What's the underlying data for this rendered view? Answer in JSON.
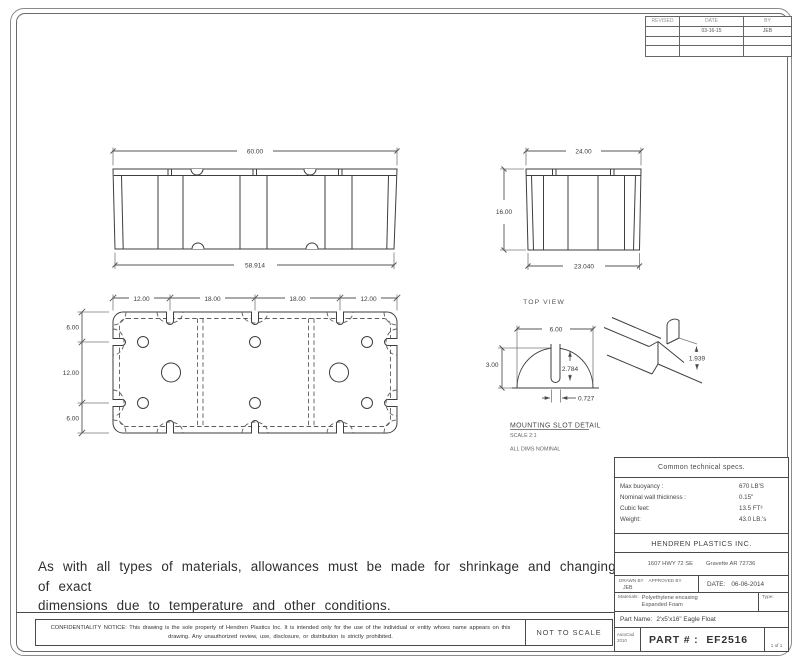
{
  "revision_table": {
    "headers": [
      "REVISED",
      "DATE",
      "BY"
    ],
    "rows": [
      {
        "revised": "",
        "date": "03-16-15",
        "by": "JEB"
      },
      {
        "revised": "",
        "date": "",
        "by": ""
      },
      {
        "revised": "",
        "date": "",
        "by": ""
      }
    ]
  },
  "views": {
    "front": {
      "dim_width_top": "60.00",
      "dim_width_bottom": "58.914"
    },
    "side": {
      "dim_width_top": "24.00",
      "dim_width_bottom": "23.040",
      "dim_height": "16.00"
    },
    "top": {
      "label": "TOP VIEW",
      "dims_top": [
        "12.00",
        "18.00",
        "18.00",
        "12.00"
      ],
      "dims_left": [
        "6.00",
        "12.00",
        "6.00"
      ]
    },
    "slot_detail": {
      "title": "MOUNTING SLOT DETAIL",
      "scale": "SCALE 2:1",
      "note": "ALL DIMS NOMINAL",
      "dim_width": "6.00",
      "dim_height": "3.00",
      "dim_depth": "2.784",
      "dim_slot_width": "0.727"
    },
    "iso_detail": {
      "dim": "1.939"
    }
  },
  "notes": {
    "disclaimer_line1": "As with all types of materials, allowances must be made for shrinkage and changing of exact",
    "disclaimer_line2": "dimensions due to temperature and other conditions."
  },
  "specs": {
    "title": "Common technical specs.",
    "rows": [
      {
        "label": "Max buoyancy :",
        "value": "670 LB'S"
      },
      {
        "label": "Nominal wall thickness :",
        "value": "0.15\""
      },
      {
        "label": "Cubic feet:",
        "value": "13.5 FT³"
      },
      {
        "label": "Weight:",
        "value": "43.0 LB.'s"
      }
    ]
  },
  "company": {
    "name": "HENDREN PLASTICS INC.",
    "address_street": "1607 HWY 72 SE",
    "address_city": "Gravette AR 72736"
  },
  "title_block": {
    "drawn_by_label": "DRAWN BY",
    "approved_by_label": "APPROVED BY",
    "drawn_by_value": "JEB",
    "date_label": "DATE:",
    "date_value": "06-06-2014",
    "materials_label": "Materials:",
    "materials_line1": "Polyethylene encasing",
    "materials_line2": "Expanded Foam",
    "type_label": "Type:",
    "part_name_label": "Part Name:",
    "part_name_value": "2'x5'x16\" Eagle Float",
    "software_line1": "AutoCad",
    "software_line2": "2010",
    "part_number_label": "PART # :",
    "part_number_value": "EF2516",
    "sheet_number": "1 of 1"
  },
  "footer": {
    "confidentiality_notice": "CONFIDENTIALITY NOTICE: This drawing is the sole property of Hendren Plastics Inc. It is intended only for the use of the individual or entity whoes name appears on this drawing. Any unauthorized review, use, disclosure, or distribution is strictly prohibited.",
    "scale_note": "NOT TO SCALE"
  }
}
